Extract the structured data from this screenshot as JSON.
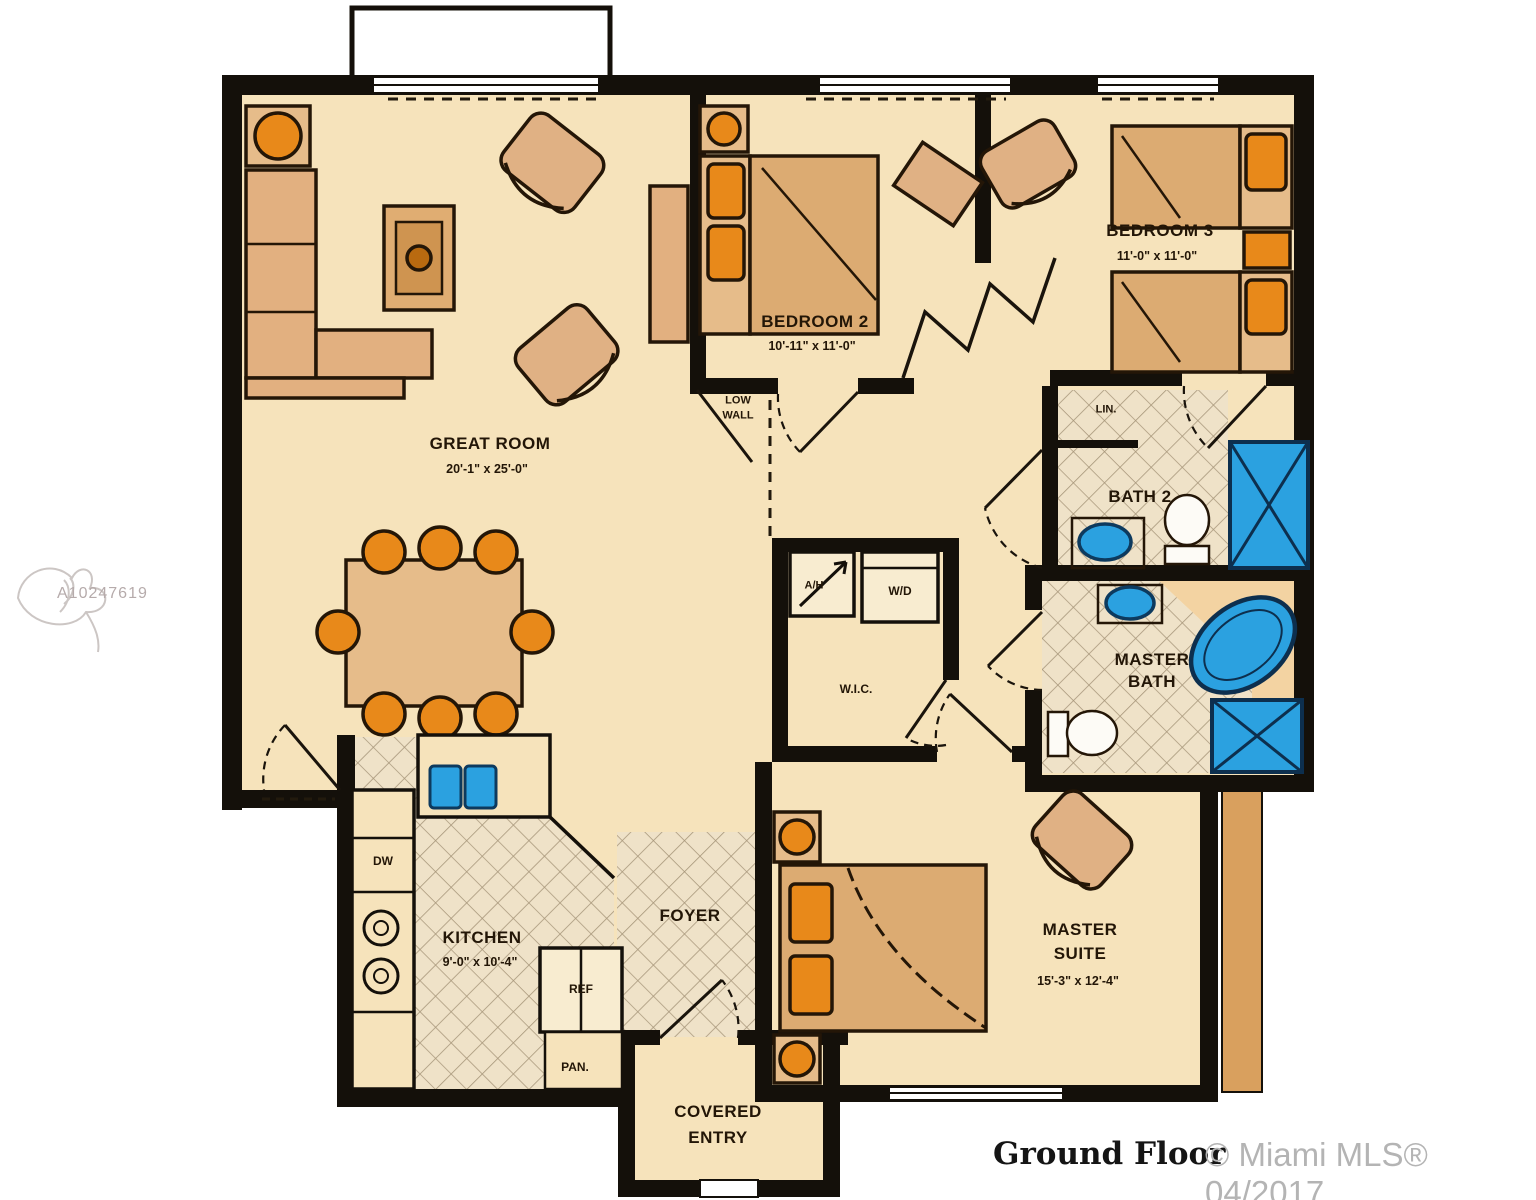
{
  "plan": {
    "watermark_id": "A10247619",
    "footer_title": "Ground Floor",
    "footer_copyright": "© Miami MLS® 04/2017"
  },
  "rooms": {
    "great_room": {
      "name": "GREAT ROOM",
      "dims": "20'-1\" x 25'-0\""
    },
    "bedroom_2": {
      "name": "BEDROOM 2",
      "dims": "10'-11\" x 11'-0\""
    },
    "bedroom_3": {
      "name": "BEDROOM 3",
      "dims": "11'-0\" x 11'-0\""
    },
    "bath_2": {
      "name": "BATH 2"
    },
    "master_bath": {
      "line1": "MASTER",
      "line2": "BATH"
    },
    "master_suite": {
      "line1": "MASTER",
      "line2": "SUITE",
      "dims": "15'-3\" x 12'-4\""
    },
    "kitchen": {
      "name": "KITCHEN",
      "dims": "9'-0\" x 10'-4\""
    },
    "foyer": {
      "name": "FOYER"
    },
    "covered_entry": {
      "line1": "COVERED",
      "line2": "ENTRY"
    },
    "wic": {
      "name": "W.I.C."
    },
    "low_wall": {
      "line1": "LOW",
      "line2": "WALL"
    },
    "linen": {
      "name": "LIN."
    },
    "washer_dryer": {
      "name": "W/D"
    },
    "air_handler": {
      "name": "A/H"
    },
    "dishwasher": {
      "name": "DW"
    },
    "refrigerator": {
      "name": "REF"
    },
    "pantry": {
      "name": "PAN."
    }
  },
  "colors": {
    "floor": "#f6e3bb",
    "wall": "#14100a",
    "tan": "#e2b080",
    "tan_dark": "#dcab72",
    "orange": "#e8891a",
    "blue": "#2ba1e0",
    "tile_line": "#a8977b"
  }
}
